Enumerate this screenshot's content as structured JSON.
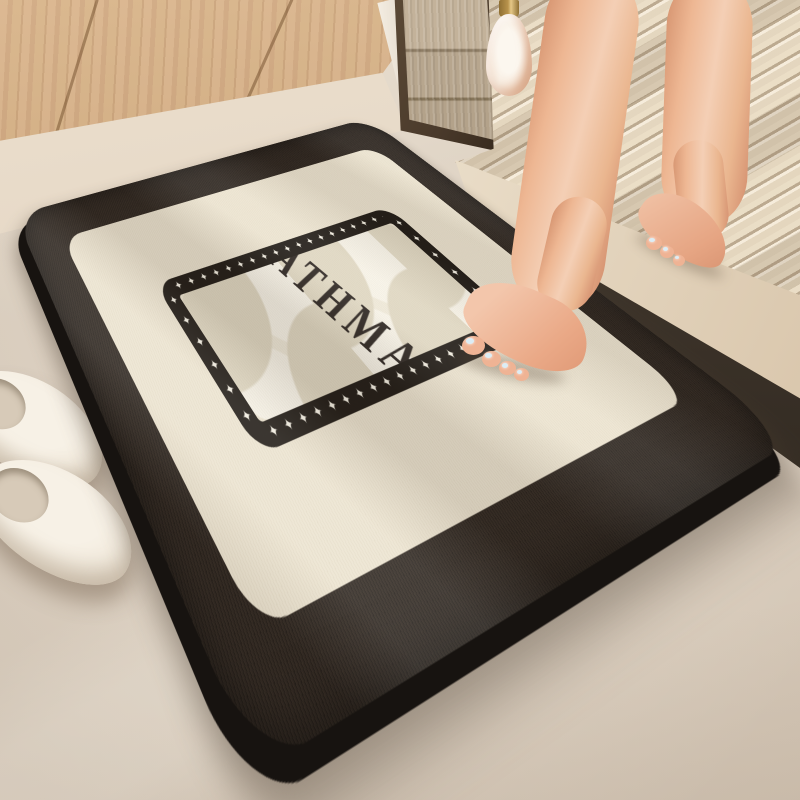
{
  "mat": {
    "brand_text": "BATHMAT",
    "star_glyph": "✦",
    "star_row_long": "✦✦✦✦✦✦✦✦✦✦✦✦✦✦✦✦✦✦✦✦",
    "star_row_short": "✦✦✦✦✦✦✦✦✦✦"
  },
  "colors": {
    "floor": "#d9ccbc",
    "wood": "#c89d6e",
    "glass": "#b7a68e",
    "frame-bronze": "#4a3a2b",
    "flute-light": "#e9dcc4",
    "flute-dark": "#b89f7c",
    "platform-face": "#e9dcc7",
    "shadow-dark": "#241e18",
    "mat-border": "#2e2620",
    "mat-cream": "#ece4d1",
    "star-band": "#1e1914",
    "mat-field": "#efe9d9",
    "petal-dark": "#e0d8c3",
    "petal-light": "#f8f4e9",
    "text-color": "#2b2420",
    "skin-light": "#f4cfb5",
    "skin-dark": "#d79672",
    "slipper": "#f0e8da",
    "bottle-glass": "#f3dcc9",
    "gold": "#b8934c",
    "nail-polish": "#dcedf5"
  }
}
